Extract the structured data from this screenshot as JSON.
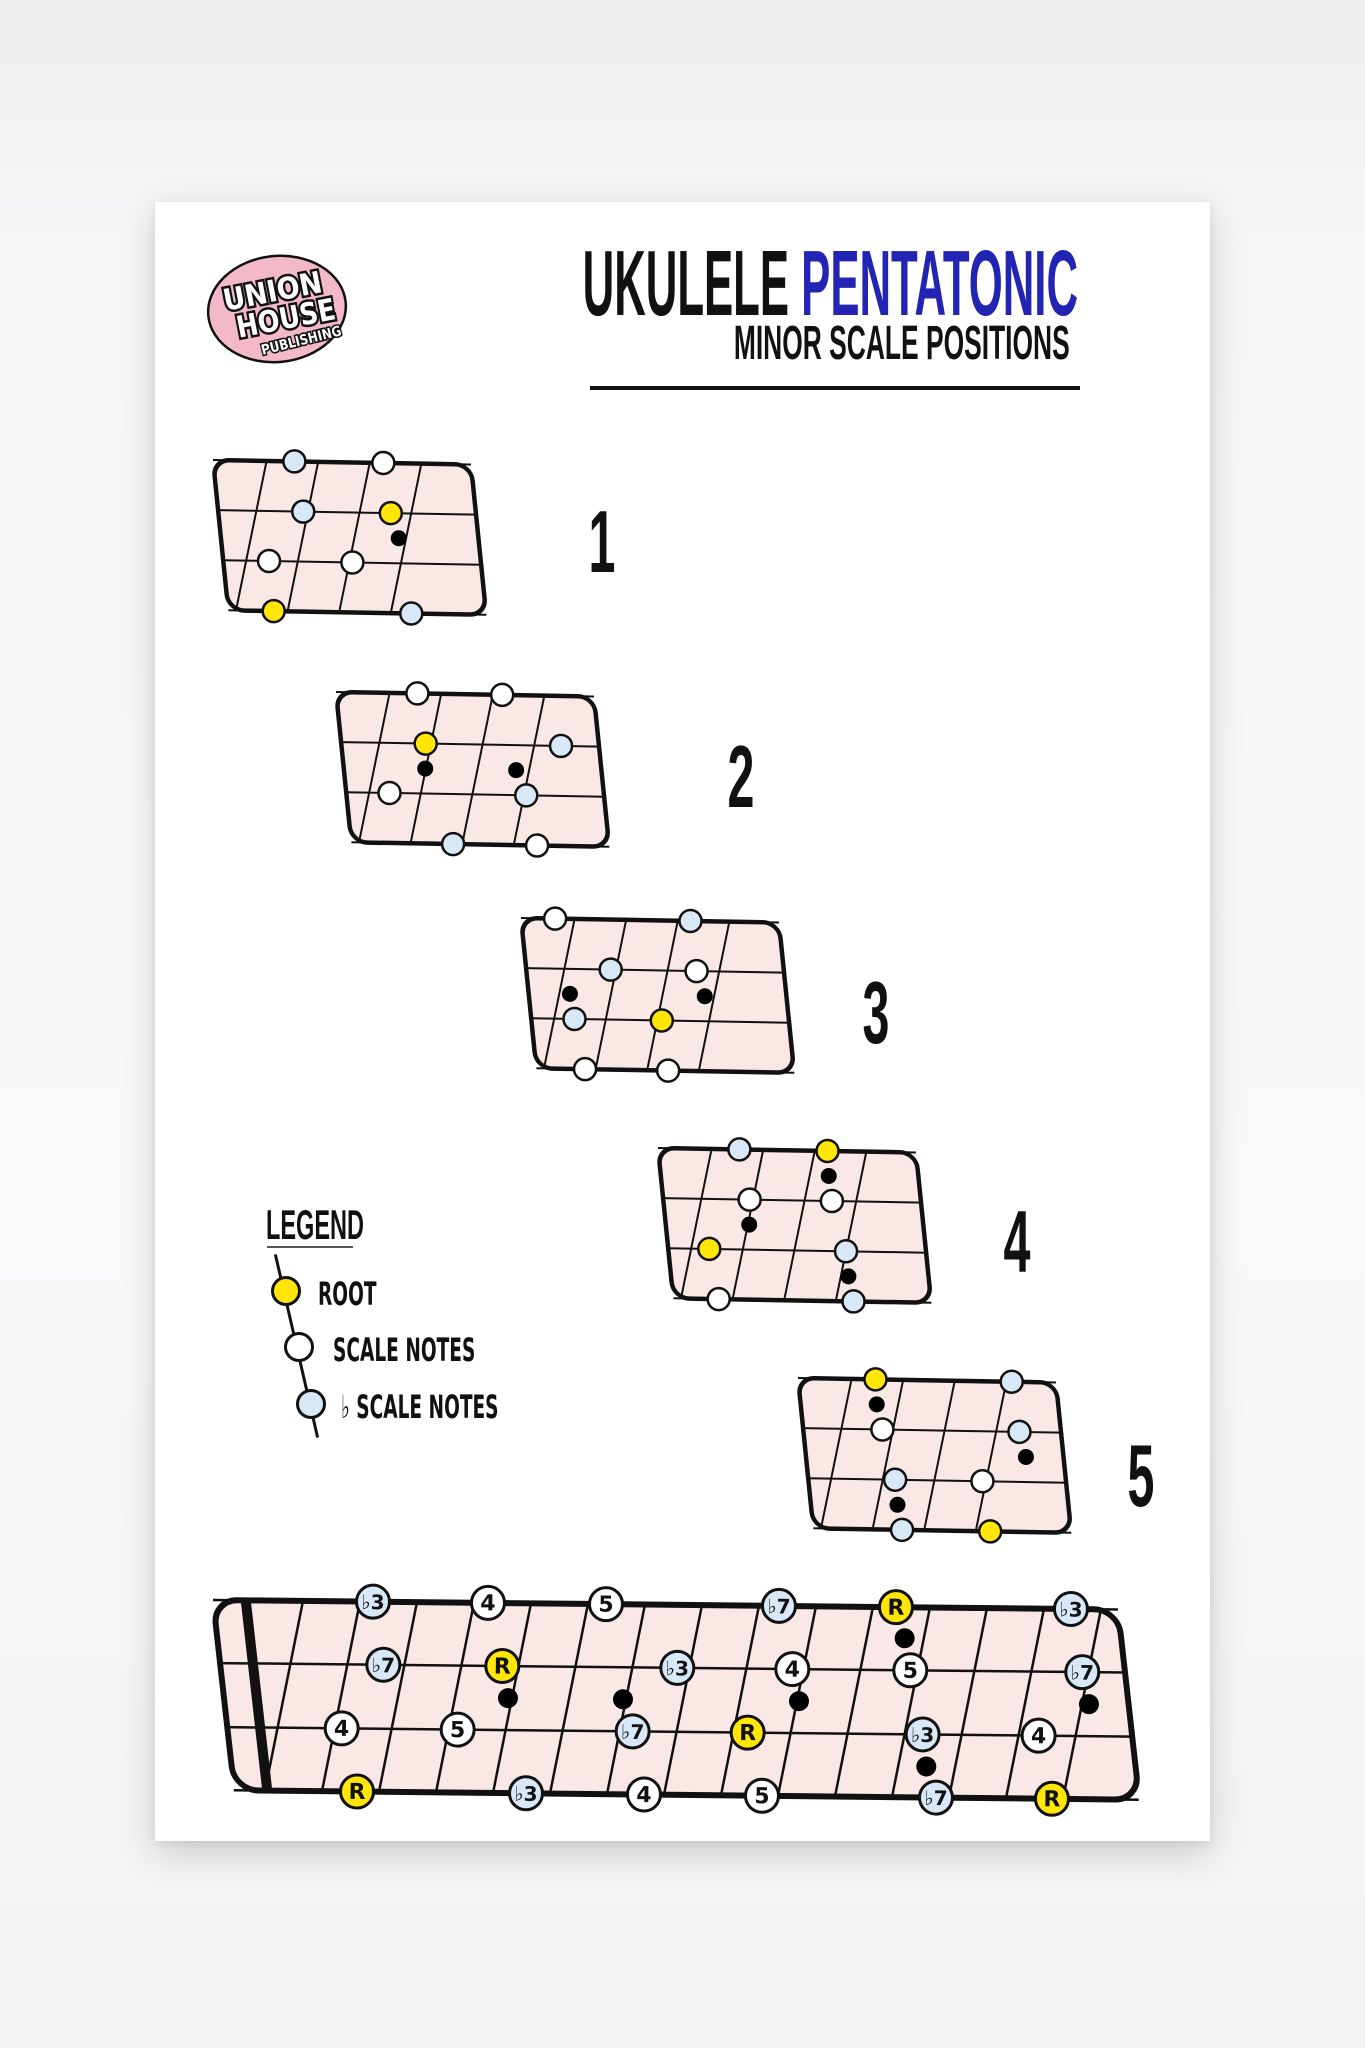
{
  "colors": {
    "page_bg": "#ffffff",
    "canvas_bg": "#f6f6f7",
    "board_fill": "#f9e8e5",
    "outline": "#111111",
    "root_fill": "#ffe606",
    "scale_fill": "#ffffff",
    "flat_fill": "#d9e8f6",
    "marker_fill": "#000000",
    "title_accent": "#2424b4",
    "logo_pink": "#f3b9c9"
  },
  "header": {
    "title_black": "UKULELE ",
    "title_blue": "PENTATONIC",
    "subtitle": "MINOR SCALE POSITIONS"
  },
  "logo": {
    "line1": "UNION",
    "line2": "HOUSE",
    "line3": "PUBLISHING"
  },
  "legend": {
    "heading": "LEGEND",
    "items": [
      {
        "type": "root",
        "label": "ROOT"
      },
      {
        "type": "scale",
        "label": "SCALE NOTES"
      },
      {
        "type": "flat",
        "label": "♭ SCALE NOTES"
      }
    ]
  },
  "positions": [
    {
      "number": "1",
      "frets_window": "2-6",
      "dots": [
        {
          "string": 1,
          "x": 0.3,
          "type": "flat"
        },
        {
          "string": 1,
          "x": 0.62,
          "type": "scale"
        },
        {
          "string": 2,
          "x": 0.335,
          "type": "flat"
        },
        {
          "string": 2,
          "x": 0.65,
          "type": "root"
        },
        {
          "string": 3,
          "x": 0.215,
          "type": "scale"
        },
        {
          "string": 3,
          "x": 0.515,
          "type": "scale"
        },
        {
          "string": 4,
          "x": 0.235,
          "type": "root"
        },
        {
          "string": 4,
          "x": 0.73,
          "type": "flat"
        }
      ],
      "markers": [
        {
          "x": 0.68,
          "between": 2.5,
          "fret": 5
        }
      ]
    },
    {
      "number": "2",
      "frets_window": "4-8",
      "dots": [
        {
          "string": 1,
          "x": 0.3,
          "type": "scale"
        },
        {
          "string": 1,
          "x": 0.605,
          "type": "scale"
        },
        {
          "string": 2,
          "x": 0.333,
          "type": "root"
        },
        {
          "string": 2,
          "x": 0.82,
          "type": "flat"
        },
        {
          "string": 3,
          "x": 0.206,
          "type": "scale"
        },
        {
          "string": 3,
          "x": 0.698,
          "type": "flat"
        },
        {
          "string": 4,
          "x": 0.438,
          "type": "flat"
        },
        {
          "string": 4,
          "x": 0.74,
          "type": "scale"
        }
      ],
      "markers": [
        {
          "x": 0.333,
          "between": 2.5,
          "fret": 5
        },
        {
          "x": 0.66,
          "between": 2.5,
          "fret": 7
        }
      ]
    },
    {
      "number": "3",
      "frets_window": "6-10",
      "dots": [
        {
          "string": 1,
          "x": 0.13,
          "type": "scale"
        },
        {
          "string": 1,
          "x": 0.617,
          "type": "flat"
        },
        {
          "string": 2,
          "x": 0.333,
          "type": "flat"
        },
        {
          "string": 2,
          "x": 0.642,
          "type": "scale"
        },
        {
          "string": 3,
          "x": 0.206,
          "type": "flat"
        },
        {
          "string": 3,
          "x": 0.52,
          "type": "root"
        },
        {
          "string": 4,
          "x": 0.247,
          "type": "scale"
        },
        {
          "string": 4,
          "x": 0.546,
          "type": "scale"
        }
      ],
      "markers": [
        {
          "x": 0.188,
          "between": 2.5,
          "fret": 7
        },
        {
          "x": 0.673,
          "between": 2.5,
          "fret": 10
        }
      ]
    },
    {
      "number": "4",
      "frets_window": "8-12",
      "dots": [
        {
          "string": 1,
          "x": 0.3,
          "type": "flat"
        },
        {
          "string": 1,
          "x": 0.617,
          "type": "root"
        },
        {
          "string": 2,
          "x": 0.34,
          "type": "scale"
        },
        {
          "string": 2,
          "x": 0.636,
          "type": "scale"
        },
        {
          "string": 3,
          "x": 0.198,
          "type": "root"
        },
        {
          "string": 3,
          "x": 0.69,
          "type": "flat"
        },
        {
          "string": 4,
          "x": 0.235,
          "type": "scale"
        },
        {
          "string": 4,
          "x": 0.72,
          "type": "flat"
        }
      ],
      "markers": [
        {
          "x": 0.623,
          "between": 1.5,
          "fret": 12
        },
        {
          "x": 0.34,
          "between": 2.5,
          "fret": 10
        },
        {
          "x": 0.7,
          "between": 3.5,
          "fret": 12
        }
      ]
    },
    {
      "number": "5",
      "frets_window": "11-15",
      "dots": [
        {
          "string": 1,
          "x": 0.286,
          "type": "root"
        },
        {
          "string": 1,
          "x": 0.776,
          "type": "flat"
        },
        {
          "string": 2,
          "x": 0.314,
          "type": "scale"
        },
        {
          "string": 2,
          "x": 0.807,
          "type": "flat"
        },
        {
          "string": 3,
          "x": 0.363,
          "type": "flat"
        },
        {
          "string": 3,
          "x": 0.677,
          "type": "scale"
        },
        {
          "string": 4,
          "x": 0.391,
          "type": "flat"
        },
        {
          "string": 4,
          "x": 0.708,
          "type": "root"
        }
      ],
      "markers": [
        {
          "x": 0.292,
          "between": 1.5,
          "fret": 12
        },
        {
          "x": 0.832,
          "between": 2.5,
          "fret": 15
        },
        {
          "x": 0.373,
          "between": 3.5,
          "fret": 12
        }
      ]
    }
  ],
  "fretboard": {
    "strings": 4,
    "frets": 15,
    "string_y": [
      0,
      63,
      127,
      190
    ],
    "notes": [
      {
        "string": 1,
        "fret": 3,
        "label": "♭3",
        "type": "flat",
        "x": 160
      },
      {
        "string": 1,
        "fret": 5,
        "label": "4",
        "type": "scale",
        "x": 275
      },
      {
        "string": 1,
        "fret": 7,
        "label": "5",
        "type": "scale",
        "x": 393
      },
      {
        "string": 1,
        "fret": 10,
        "label": "♭7",
        "type": "flat",
        "x": 566
      },
      {
        "string": 1,
        "fret": 12,
        "label": "R",
        "type": "root",
        "x": 683
      },
      {
        "string": 1,
        "fret": 15,
        "label": "♭3",
        "type": "flat",
        "x": 858
      },
      {
        "string": 2,
        "fret": 3,
        "label": "♭7",
        "type": "flat",
        "x": 171
      },
      {
        "string": 2,
        "fret": 5,
        "label": "R",
        "type": "root",
        "x": 290
      },
      {
        "string": 2,
        "fret": 8,
        "label": "♭3",
        "type": "flat",
        "x": 465
      },
      {
        "string": 2,
        "fret": 10,
        "label": "4",
        "type": "scale",
        "x": 580
      },
      {
        "string": 2,
        "fret": 12,
        "label": "5",
        "type": "scale",
        "x": 698
      },
      {
        "string": 2,
        "fret": 15,
        "label": "♭7",
        "type": "flat",
        "x": 870
      },
      {
        "string": 3,
        "fret": 2,
        "label": "4",
        "type": "scale",
        "x": 130
      },
      {
        "string": 3,
        "fret": 4,
        "label": "5",
        "type": "scale",
        "x": 246
      },
      {
        "string": 3,
        "fret": 7,
        "label": "♭7",
        "type": "flat",
        "x": 421
      },
      {
        "string": 3,
        "fret": 9,
        "label": "R",
        "type": "root",
        "x": 536
      },
      {
        "string": 3,
        "fret": 12,
        "label": "♭3",
        "type": "flat",
        "x": 711
      },
      {
        "string": 3,
        "fret": 14,
        "label": "4",
        "type": "scale",
        "x": 827
      },
      {
        "string": 4,
        "fret": 2,
        "label": "R",
        "type": "root",
        "x": 146
      },
      {
        "string": 4,
        "fret": 5,
        "label": "♭3",
        "type": "flat",
        "x": 315
      },
      {
        "string": 4,
        "fret": 7,
        "label": "4",
        "type": "scale",
        "x": 433
      },
      {
        "string": 4,
        "fret": 9,
        "label": "5",
        "type": "scale",
        "x": 551
      },
      {
        "string": 4,
        "fret": 12,
        "label": "♭7",
        "type": "flat",
        "x": 725
      },
      {
        "string": 4,
        "fret": 14,
        "label": "R",
        "type": "root",
        "x": 841
      }
    ],
    "inlay_markers": [
      {
        "fret": 5,
        "x": 296,
        "y": 95
      },
      {
        "fret": 7,
        "x": 411,
        "y": 95
      },
      {
        "fret": 10,
        "x": 587,
        "y": 95
      },
      {
        "fret": 12,
        "x": 692,
        "y": 31
      },
      {
        "fret": 12,
        "x": 715,
        "y": 159
      },
      {
        "fret": 15,
        "x": 877,
        "y": 95
      }
    ]
  },
  "mini_layout": [
    {
      "left": 203,
      "top": 443
    },
    {
      "left": 326,
      "top": 675
    },
    {
      "left": 511,
      "top": 901
    },
    {
      "left": 648,
      "top": 1131
    },
    {
      "left": 788,
      "top": 1361
    }
  ],
  "number_layout": [
    {
      "cx": 602,
      "cy": 498
    },
    {
      "cx": 741,
      "cy": 733
    },
    {
      "cx": 876,
      "cy": 969
    },
    {
      "cx": 1017,
      "cy": 1198
    },
    {
      "cx": 1141,
      "cy": 1432
    }
  ]
}
